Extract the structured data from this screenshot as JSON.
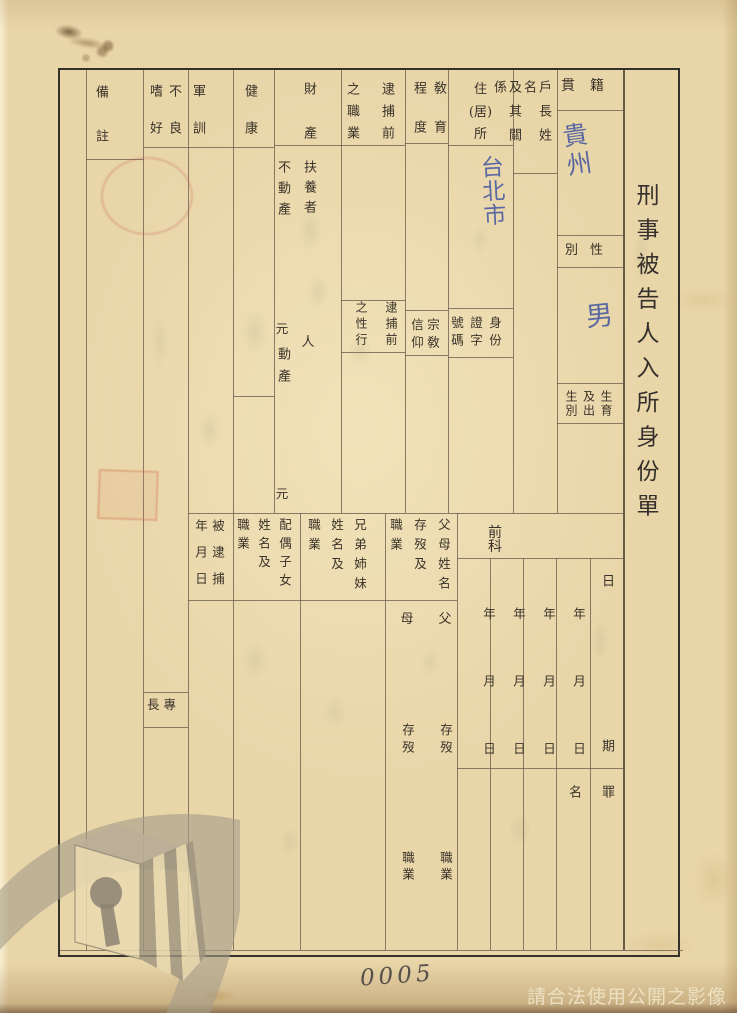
{
  "title": "刑事被告人入所身份單",
  "page": {
    "page_number": "0005",
    "usage_watermark": "請合法使用公開之影像"
  },
  "form": {
    "native_place": {
      "label": "籍貫",
      "value": "貴州"
    },
    "sex": {
      "label": "性別",
      "value": "男"
    },
    "birth_info": {
      "label": "生育\n及出\n生別"
    },
    "householder": {
      "label": "戶長姓名\n及其關係"
    },
    "residence": {
      "label": "住\n(居)\n所",
      "value": "台北市"
    },
    "id_card_number": {
      "label": "身份\n證字\n號碼"
    },
    "education": {
      "label": "敎育\n程度"
    },
    "religion": {
      "label": "宗敎\n信仰"
    },
    "pre_arrest_occupation": {
      "label": "逮捕前\n之職業"
    },
    "pre_arrest_conduct": {
      "label": "逮捕前\n之性行"
    },
    "property": {
      "label": "財產",
      "dependents_label": "扶養者",
      "dependents_unit": "人",
      "real_estate_label": "不動產",
      "movable_label": "動產",
      "currency_unit": "元"
    },
    "health": {
      "label": "健康"
    },
    "military_training": {
      "label": "軍訓"
    },
    "bad_habits": {
      "label": "不良\n嗜好"
    },
    "specialty": {
      "label": "專長"
    },
    "remarks": {
      "label": "備註"
    },
    "criminal_record": {
      "label": "前科",
      "date_label": "日期",
      "crime_label": "罪名",
      "date_column_label": "年月日"
    },
    "parents": {
      "label": "父母姓名\n存歿及\n職業",
      "father_label": "父",
      "mother_label": "母",
      "living_status_label": "存歿",
      "occupation_label": "職業"
    },
    "siblings": {
      "label": "兄弟姉妹\n姓名及\n職業"
    },
    "spouse_children": {
      "label": "配偶子女\n姓名及\n職業"
    },
    "arrest_date": {
      "label": "被逮捕\n年月日"
    }
  }
}
